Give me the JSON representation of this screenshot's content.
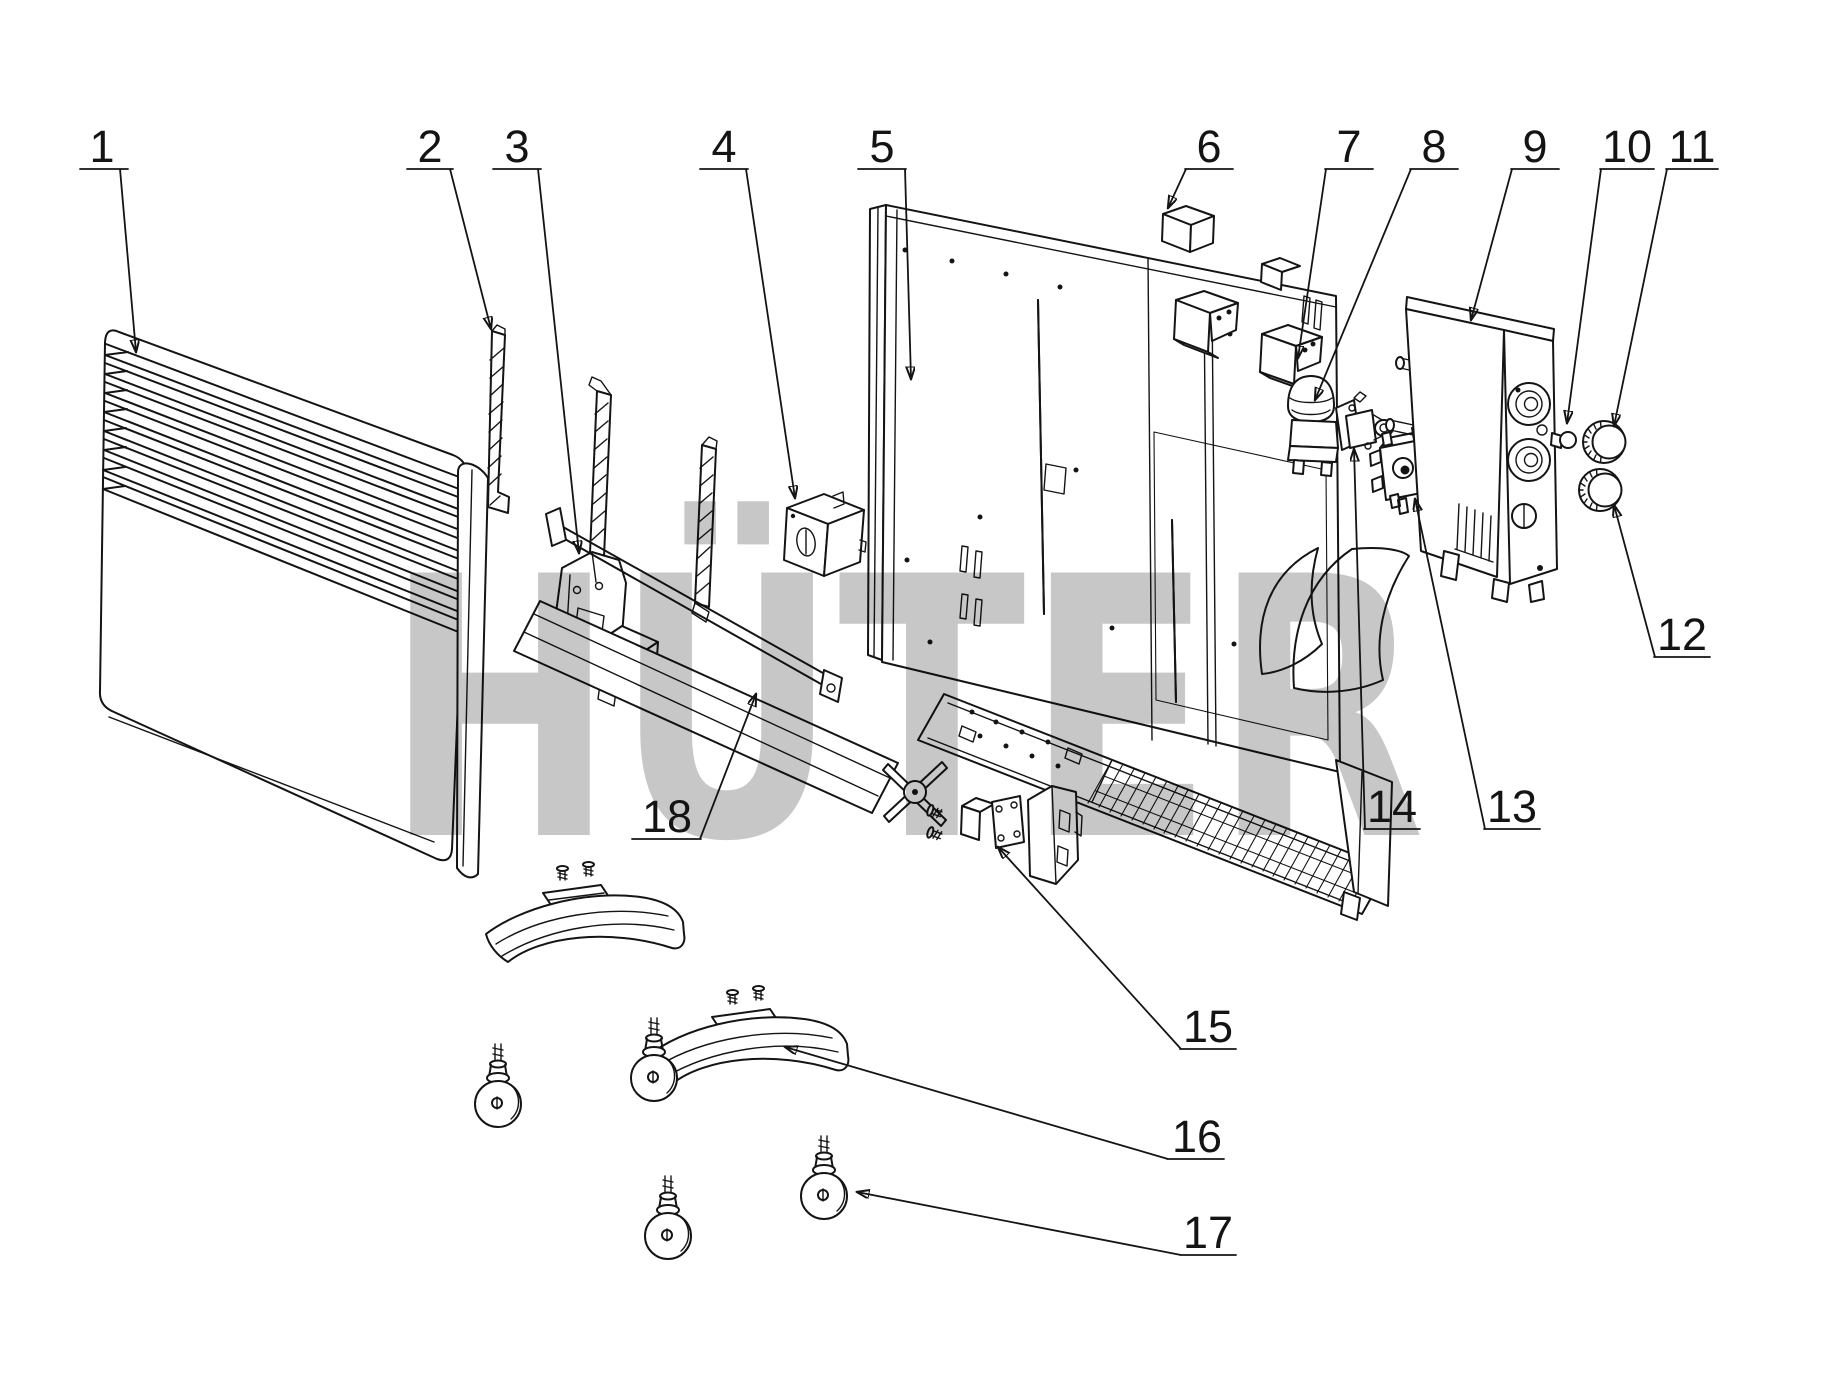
{
  "watermark": {
    "text": "HÜTER",
    "color": "#c7c7c7",
    "logo_red": "#f19390",
    "logo_yellow": "#f9f2a0"
  },
  "drawing": {
    "line_color": "#141414",
    "background": "#ffffff",
    "part_count": 18
  },
  "labels": [
    {
      "n": "1"
    },
    {
      "n": "2"
    },
    {
      "n": "3"
    },
    {
      "n": "4"
    },
    {
      "n": "5"
    },
    {
      "n": "6"
    },
    {
      "n": "7"
    },
    {
      "n": "8"
    },
    {
      "n": "9"
    },
    {
      "n": "10"
    },
    {
      "n": "11"
    },
    {
      "n": "12"
    },
    {
      "n": "13"
    },
    {
      "n": "14"
    },
    {
      "n": "15"
    },
    {
      "n": "16"
    },
    {
      "n": "17"
    },
    {
      "n": "18"
    }
  ]
}
